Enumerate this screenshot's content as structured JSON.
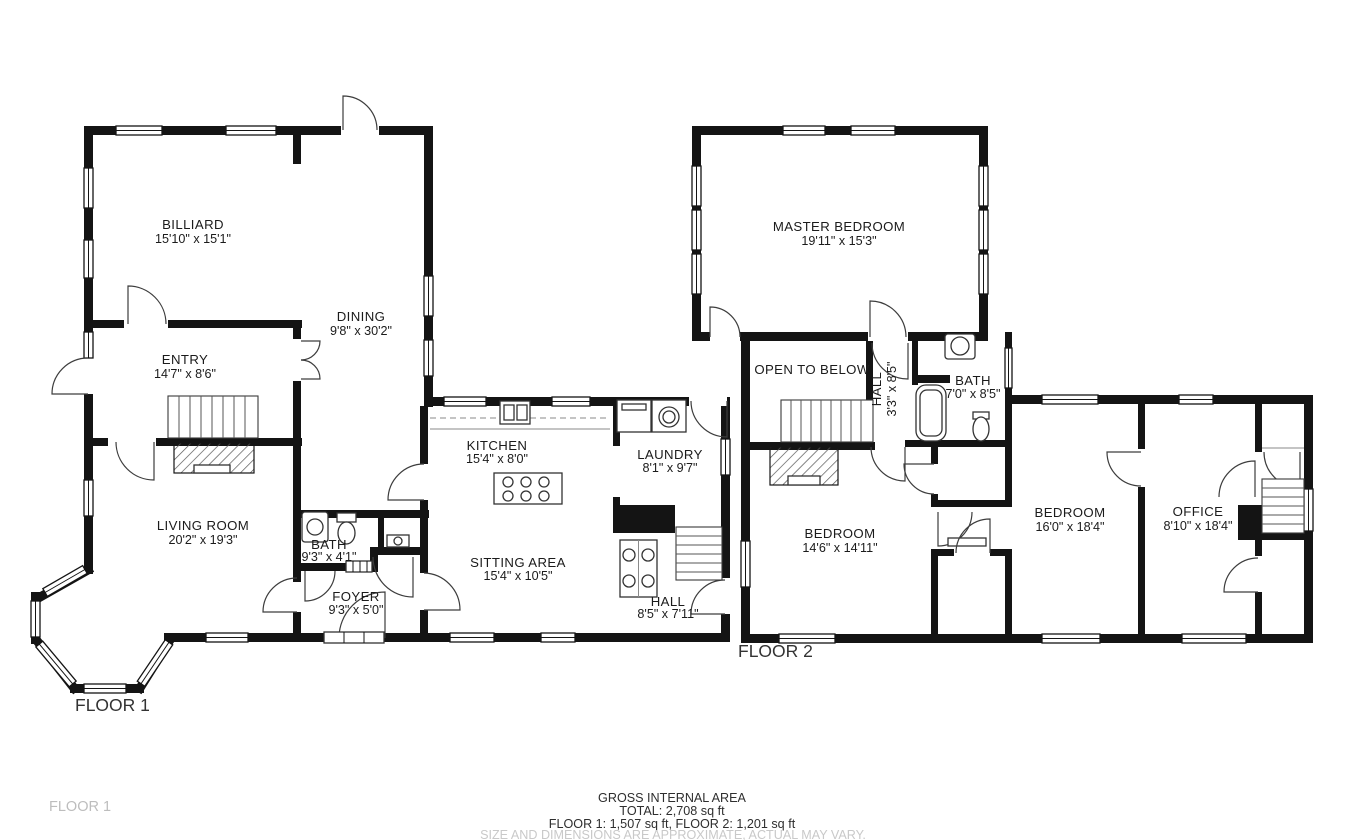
{
  "floor1": {
    "label": "FLOOR 1",
    "rooms": {
      "billiard": {
        "name": "BILLIARD",
        "dims": "15'10\" x 15'1\""
      },
      "entry": {
        "name": "ENTRY",
        "dims": "14'7\" x 8'6\""
      },
      "dining": {
        "name": "DINING",
        "dims": "9'8\" x 30'2\""
      },
      "living_room": {
        "name": "LIVING ROOM",
        "dims": "20'2\" x 19'3\""
      },
      "bath": {
        "name": "BATH",
        "dims": "9'3\" x 4'1\""
      },
      "foyer": {
        "name": "FOYER",
        "dims": "9'3\" x 5'0\""
      },
      "kitchen": {
        "name": "KITCHEN",
        "dims": "15'4\" x 8'0\""
      },
      "laundry": {
        "name": "LAUNDRY",
        "dims": "8'1\" x 9'7\""
      },
      "sitting_area": {
        "name": "SITTING AREA",
        "dims": "15'4\" x 10'5\""
      },
      "hall": {
        "name": "HALL",
        "dims": "8'5\" x 7'11\""
      }
    }
  },
  "floor2": {
    "label": "FLOOR 2",
    "rooms": {
      "master_bedroom": {
        "name": "MASTER BEDROOM",
        "dims": "19'11\" x 15'3\""
      },
      "open_to_below": {
        "name": "OPEN TO BELOW",
        "dims": ""
      },
      "hall": {
        "name": "HALL",
        "dims": "3'3\" x 8'5\""
      },
      "bath": {
        "name": "BATH",
        "dims": "7'0\" x 8'5\""
      },
      "bedroom_1": {
        "name": "BEDROOM",
        "dims": "14'6\" x 14'11\""
      },
      "bedroom_2": {
        "name": "BEDROOM",
        "dims": "16'0\" x 18'4\""
      },
      "office": {
        "name": "OFFICE",
        "dims": "8'10\" x 18'4\""
      }
    }
  },
  "footer": {
    "title": "GROSS INTERNAL AREA",
    "total": "TOTAL: 2,708 sq ft",
    "floor_breakdown": "FLOOR 1: 1,507 sq ft, FLOOR 2: 1,201 sq ft",
    "disclaimer": "SIZE AND DIMENSIONS ARE APPROXIMATE, ACTUAL MAY VARY."
  },
  "watermark": "FLOOR 1",
  "colors": {
    "wall": "#141414",
    "muted_text": "#c9c9c9",
    "watermark_text": "#bdbdbd"
  }
}
